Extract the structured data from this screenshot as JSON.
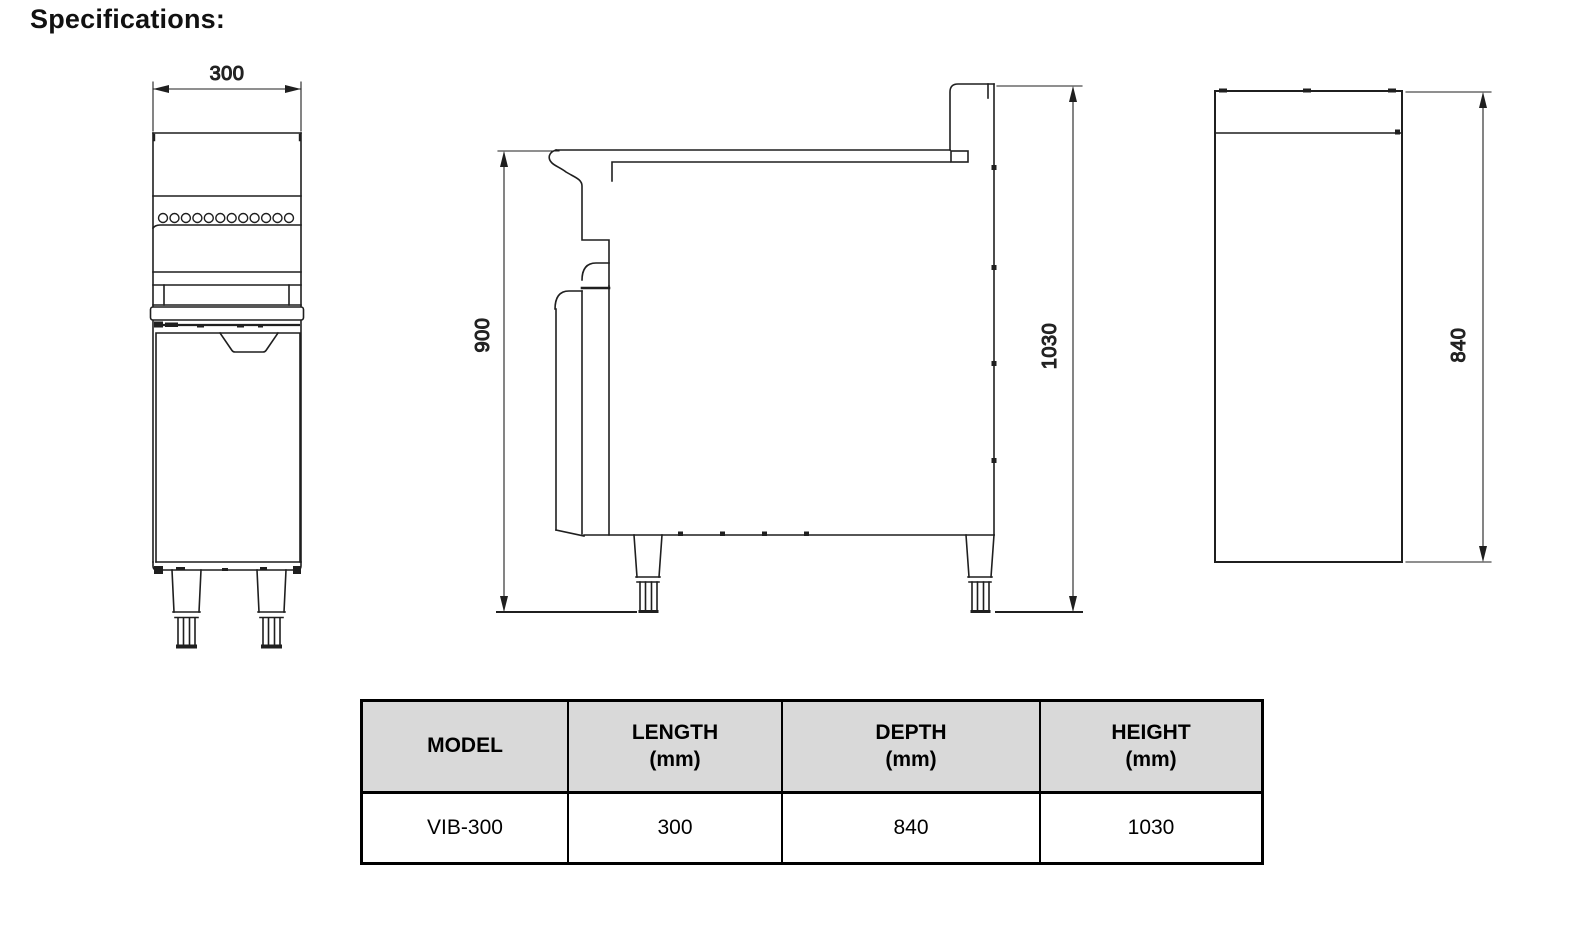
{
  "title": "Specifications:",
  "drawings": {
    "front_view": {
      "width_dim": "300"
    },
    "side_view": {
      "worktop_height_dim": "900",
      "overall_height_dim": "1030"
    },
    "top_view": {
      "depth_dim": "840"
    }
  },
  "spec_table": {
    "headers": [
      {
        "label": "MODEL",
        "unit": ""
      },
      {
        "label": "LENGTH",
        "unit": "(mm)"
      },
      {
        "label": "DEPTH",
        "unit": "(mm)"
      },
      {
        "label": "HEIGHT",
        "unit": "(mm)"
      }
    ],
    "rows": [
      {
        "model": "VIB-300",
        "length_mm": "300",
        "depth_mm": "840",
        "height_mm": "1030"
      }
    ]
  },
  "colors": {
    "line": "#1f1f1f",
    "table_header_bg": "#d9d9d9",
    "table_border": "#000000",
    "background": "#ffffff"
  }
}
